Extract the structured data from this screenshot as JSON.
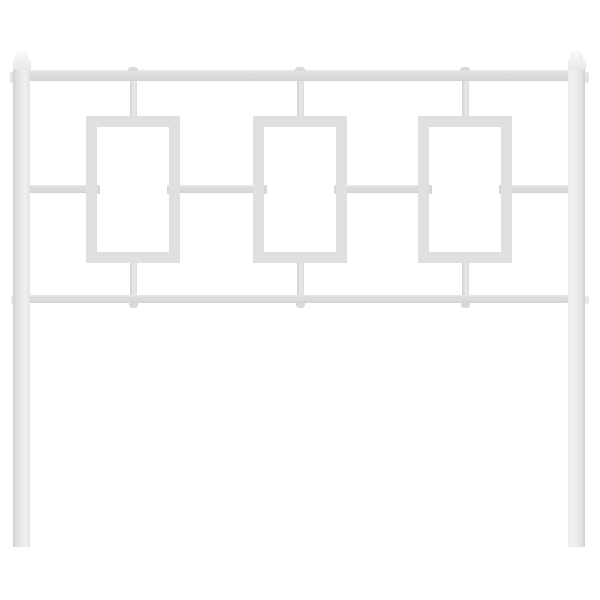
{
  "scene": {
    "description": "Product photo of a white metal headboard on a plain white background: two square vertical posts with rounded ball finial caps, a thick top rail, a middle rail and a bottom rail, three open rectangular panel cutouts connected to the rails by short vertical bars, weld nubs at the joints, and two screw holes in each lower leg.",
    "background": "#ffffff"
  },
  "colors": {
    "bg": "#ffffff",
    "metal": "#dcdcdc",
    "metal_hi": "#f0f0f0",
    "metal_lo": "#d2d2d2",
    "frame": "#e0e0e0",
    "cap": "#f1f1f1",
    "weld": "#d9d9d9",
    "tick": "#c8c8c8",
    "hole": "#ffffff"
  },
  "structure": {
    "posts": 2,
    "finials": 2,
    "rails": 3,
    "panels": 3,
    "connectors_per_panel": 2,
    "screw_holes_per_leg": 2
  }
}
